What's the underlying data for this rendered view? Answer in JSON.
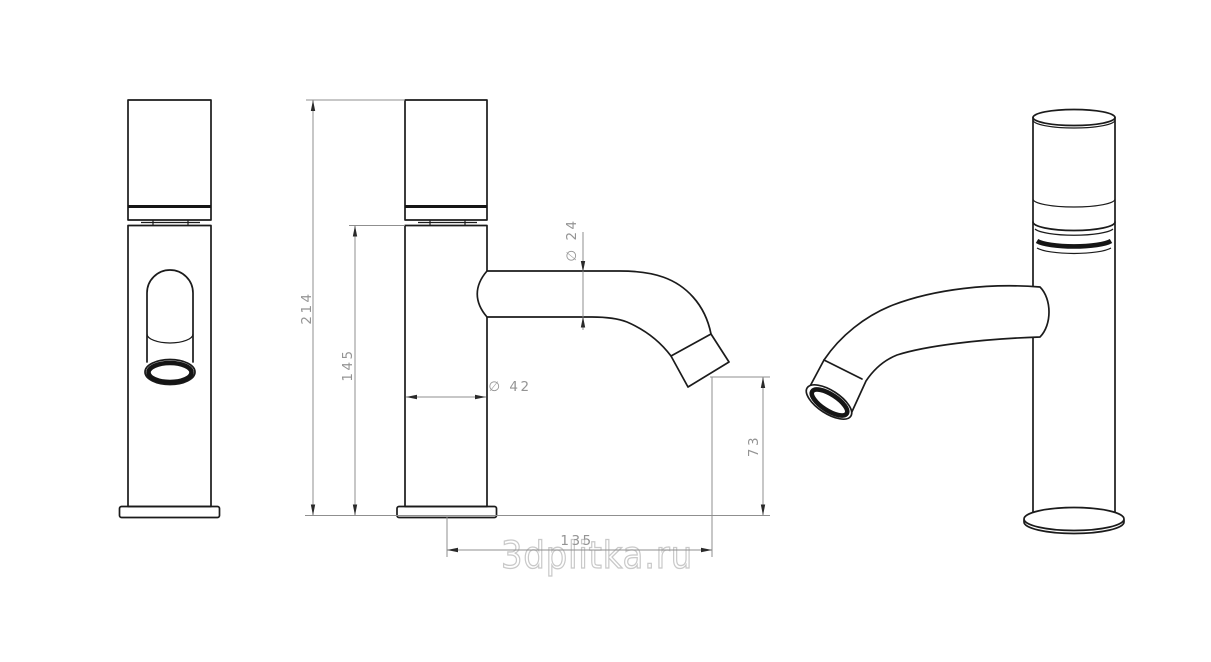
{
  "watermark": "3dplitka.ru",
  "dims": {
    "overall_height": "214",
    "body_height": "145",
    "spout_diameter": "∅ 24",
    "body_diameter": "∅ 42",
    "outlet_height": "73",
    "spout_reach": "135"
  },
  "colors": {
    "background": "#ffffff",
    "outline": "#1b1b1b",
    "dimension_lines": "#8f8f8f",
    "dimension_text": "#949494",
    "watermark": "#c9c9c9"
  }
}
